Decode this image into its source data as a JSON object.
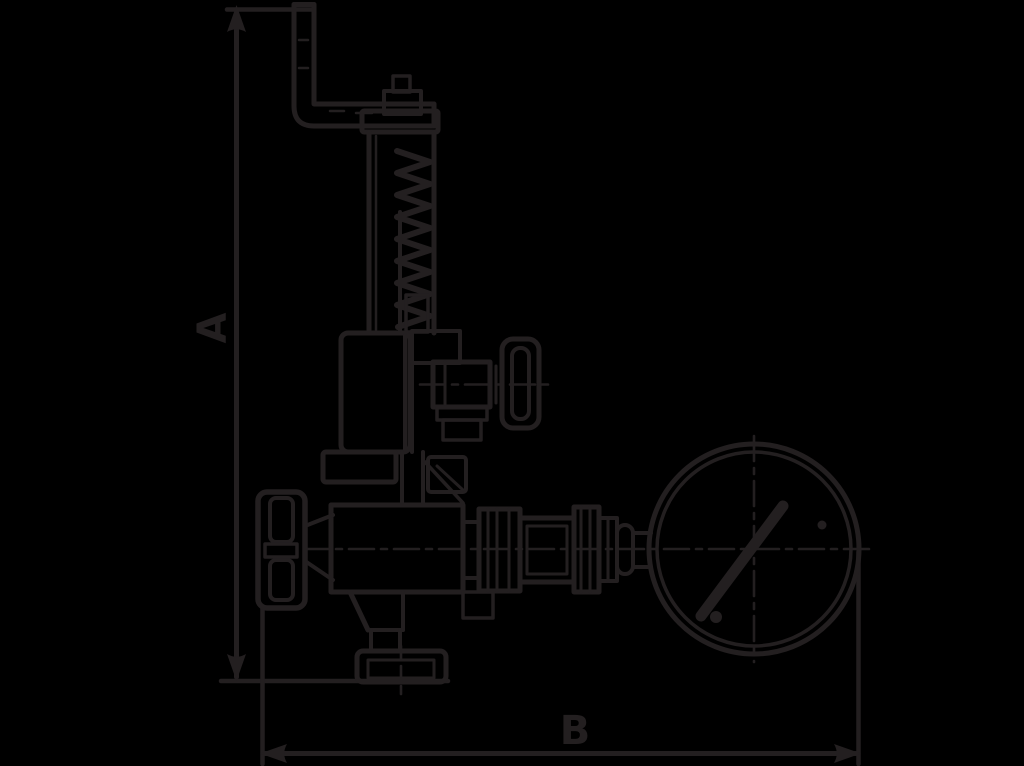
{
  "diagram": {
    "type": "technical-line-drawing",
    "subject": "spring-loaded safety valve with test lever, handwheel and pressure gauge, dimensional outline drawing",
    "colors": {
      "background": "#000000",
      "line": "#231f20"
    },
    "dimension_a": {
      "label": "A",
      "orientation": "vertical"
    },
    "dimension_b": {
      "label": "B",
      "orientation": "horizontal"
    }
  }
}
